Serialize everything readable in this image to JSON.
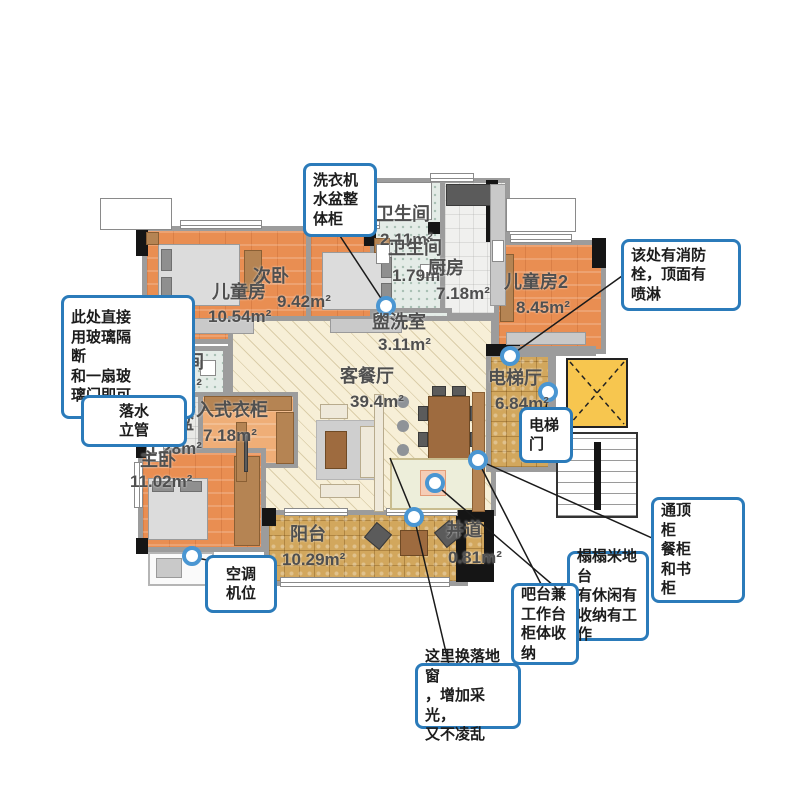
{
  "plan_title": "四室两厅户型图",
  "colors": {
    "callout_border": "#2b7bba",
    "wall_gray": "#9c9c9c",
    "wall_column": "#151515",
    "bedroom_floor": "#e98e52",
    "living_floor": "#f7efd7",
    "bath_floor": "#e4ece7",
    "balcony_tile": "#d2a75d",
    "elevator_shaft": "#f7c64f",
    "label_text": "#4f4f4f",
    "marker_ring": "#4a96d2"
  },
  "rooms": [
    {
      "name": "儿童房",
      "area": "10.54m²"
    },
    {
      "name": "次卧",
      "area": "9.42m²"
    },
    {
      "name": "卫生间",
      "area": "2.11m²"
    },
    {
      "name": "卫生间",
      "area": "1.79m²"
    },
    {
      "name": "厨房",
      "area": "7.18m²"
    },
    {
      "name": "儿童房2",
      "area": "8.45m²"
    },
    {
      "name": "盥洗室",
      "area": "3.11m²"
    },
    {
      "name": "客餐厅",
      "area": "39.4m²"
    },
    {
      "name": "电梯厅",
      "area": "6.84m²"
    },
    {
      "name": "卫生间",
      "area": "2.29m²"
    },
    {
      "name": "卫生间",
      "area": "1.64m²"
    },
    {
      "name": "洗手盆",
      "area": "1.28m²"
    },
    {
      "name": "步入式衣柜",
      "area": "7.18m²"
    },
    {
      "name": "主卧",
      "area": "11.02m²"
    },
    {
      "name": "阳台",
      "area": "10.29m²"
    },
    {
      "name": "井道",
      "area": "0.81m²"
    }
  ],
  "callouts": [
    {
      "id": "laundry-cabinet",
      "text": "洗衣机\n水盆整\n体柜"
    },
    {
      "id": "fire-hydrant",
      "text": "该处有消防\n栓，顶面有\n喷淋"
    },
    {
      "id": "glass-partition",
      "text": "此处直接\n用玻璃隔\n断\n和一扇玻\n璃门即可"
    },
    {
      "id": "downpipe",
      "text": "落水\n立管"
    },
    {
      "id": "elevator-door",
      "text": "电梯\n门"
    },
    {
      "id": "ceiling-cabinet",
      "text": "通顶\n柜\n餐柜\n和书\n柜"
    },
    {
      "id": "tatami",
      "text": "榻榻米地\n台\n有休闲有\n收纳有工\n作"
    },
    {
      "id": "bar-counter",
      "text": "吧台兼\n工作台\n柜体收\n纳"
    },
    {
      "id": "ac-unit",
      "text": "空调\n机位"
    },
    {
      "id": "french-window",
      "text": "这里换落地窗\n，增加采光，\n又不凌乱"
    }
  ]
}
